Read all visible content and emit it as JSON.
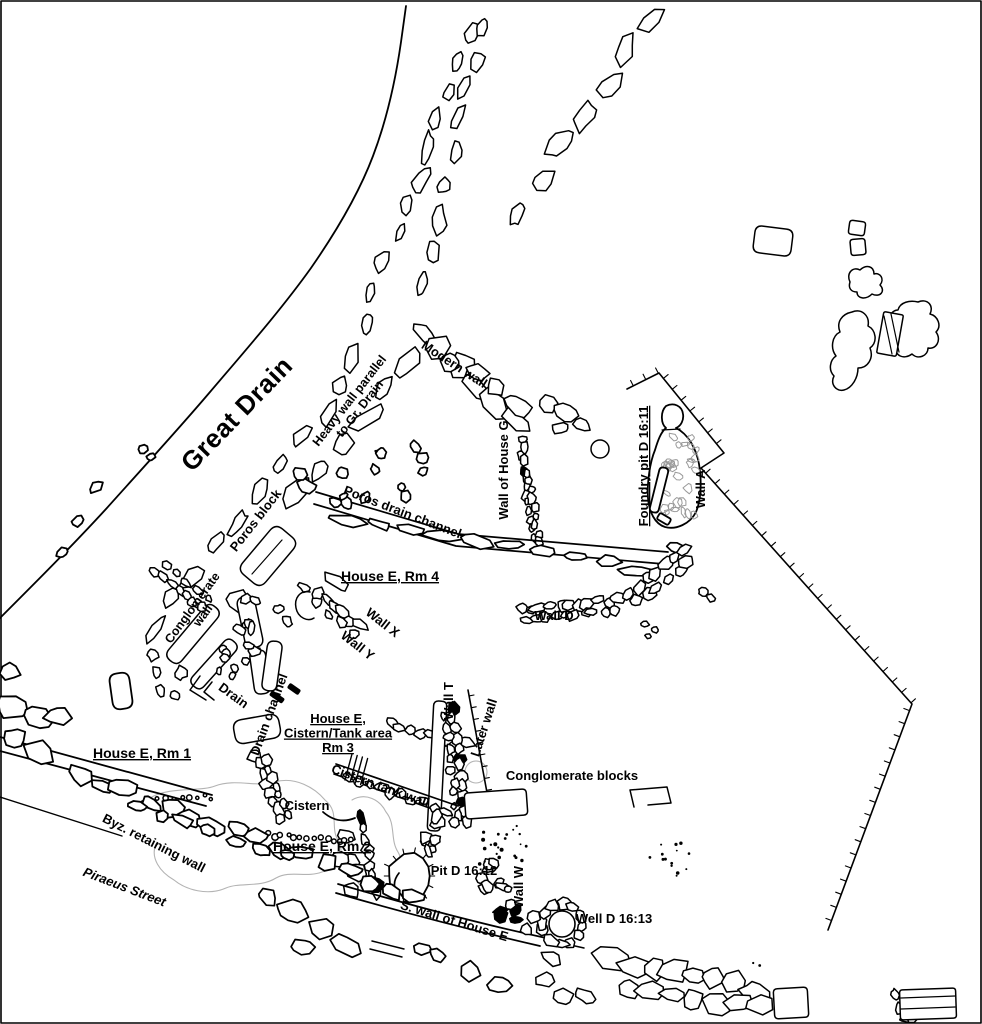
{
  "colors": {
    "background": "#ffffff",
    "ink": "#000000",
    "faint": "#b3b3b3",
    "gravel": "#9a9a9a"
  },
  "labels": {
    "great_drain": {
      "text": "Great Drain"
    },
    "modern_wall": {
      "text": "Modern wall"
    },
    "heavy_wall": {
      "line1": "Heavy wall parallel",
      "line2": "to Gr. Drain"
    },
    "wall_house_g": {
      "text": "Wall of House G"
    },
    "foundry_pit": {
      "text": "Foundry pit D 16:11"
    },
    "wall_a": {
      "text": "Wall A"
    },
    "poros_block": {
      "text": "Poros block"
    },
    "poros_drain_channel": {
      "text": "Poros drain channel"
    },
    "house_e_rm4": {
      "text": "House E, Rm 4"
    },
    "wall_x": {
      "text": "Wall X"
    },
    "wall_y": {
      "text": "Wall Y"
    },
    "conglomerate_wall": {
      "line1": "Conglomerate",
      "line2": "wall"
    },
    "wall_d": {
      "text": "Wall D"
    },
    "drain": {
      "text": "Drain"
    },
    "drain_channel": {
      "text": "Drain channel"
    },
    "house_e_cistern": {
      "line1": "House E,",
      "line2": "Cistern/Tank area",
      "line3": "Rm 3"
    },
    "wall_t": {
      "text": "Wall T"
    },
    "later_wall": {
      "text": "Later wall"
    },
    "cistern_tank_wall": {
      "text": "Cistern tank wall"
    },
    "conglomerate_blocks": {
      "text": "Conglomerate blocks"
    },
    "house_e_rm1": {
      "text": "House E, Rm 1"
    },
    "cistern": {
      "text": "Cistern"
    },
    "byz_retaining_wall": {
      "text": "Byz. retaining wall"
    },
    "house_e_rm2": {
      "text": "House E, Rm 2"
    },
    "piraeus_street": {
      "text": "Piraeus Street"
    },
    "pit_d_16_12": {
      "text": "Pit D 16:12"
    },
    "wall_w": {
      "text": "Wall W"
    },
    "s_wall_house_e": {
      "text": "S. wall of House E"
    },
    "well_d_16_13": {
      "text": "Well D 16:13"
    }
  }
}
